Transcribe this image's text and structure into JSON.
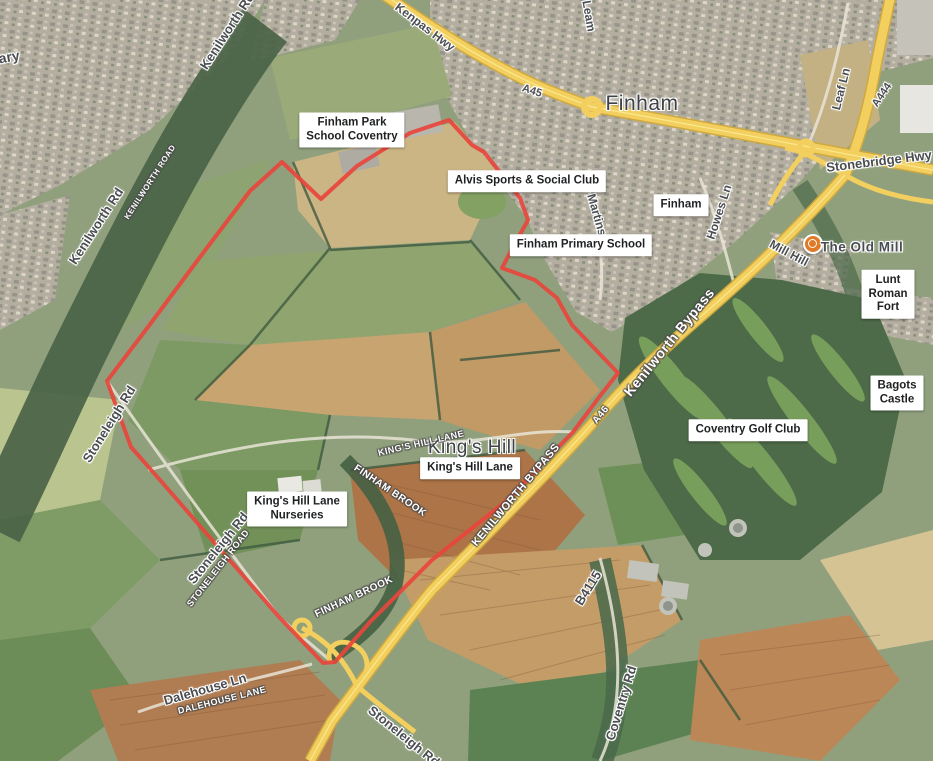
{
  "map": {
    "colors": {
      "boundary_red": "#e8453c",
      "highway_yellow": "#f4d263",
      "label_gray": "#4a4d51",
      "boxed_label_bg": "#ffffff",
      "marker_orange": "#e07a26"
    },
    "city_label": {
      "text": "Finham"
    },
    "area_label": {
      "text": "King's Hill"
    },
    "poi_marker": {
      "label": "The Old Mill"
    },
    "gray_labels": [
      {
        "text": "Library",
        "x": -4,
        "y": 59,
        "rot": -10,
        "size": 14
      },
      {
        "text": "Kenilworth Rd",
        "x": 227,
        "y": 31,
        "rot": -57,
        "size": 13
      },
      {
        "text": "Leam",
        "x": 589,
        "y": 16,
        "rot": 80,
        "size": 12
      },
      {
        "text": "Kenpas Hwy",
        "x": 425,
        "y": 27,
        "rot": 37,
        "size": 12
      },
      {
        "text": "Leaf Ln",
        "x": 841,
        "y": 89,
        "rot": -76,
        "size": 12
      },
      {
        "text": "A444",
        "x": 882,
        "y": 95,
        "rot": -56,
        "size": 11
      },
      {
        "text": "A45",
        "x": 532,
        "y": 91,
        "rot": 18,
        "size": 11
      },
      {
        "text": "Stonebridge Hwy",
        "x": 879,
        "y": 161,
        "rot": -7,
        "size": 13
      },
      {
        "text": "Mill Hill",
        "x": 789,
        "y": 253,
        "rot": 28,
        "size": 12
      },
      {
        "text": "Howes Ln",
        "x": 719,
        "y": 212,
        "rot": -72,
        "size": 12
      },
      {
        "text": "St. Martins Rd",
        "x": 597,
        "y": 215,
        "rot": 74,
        "size": 12
      },
      {
        "text": "Kenilworth Rd",
        "x": 96,
        "y": 226,
        "rot": -57,
        "size": 13
      },
      {
        "text": "Stoneleigh Rd",
        "x": 109,
        "y": 424,
        "rot": -58,
        "size": 13
      },
      {
        "text": "Stoneleigh Rd",
        "x": 218,
        "y": 548,
        "rot": -51,
        "size": 13
      },
      {
        "text": "Dalehouse Ln",
        "x": 205,
        "y": 689,
        "rot": -16,
        "size": 13
      },
      {
        "text": "B4115",
        "x": 588,
        "y": 588,
        "rot": -58,
        "size": 13
      },
      {
        "text": "Coventry Rd",
        "x": 621,
        "y": 703,
        "rot": -73,
        "size": 13
      },
      {
        "text": "Stoneleigh Rd",
        "x": 404,
        "y": 736,
        "rot": 39,
        "size": 13
      }
    ],
    "white_labels": [
      {
        "text": "KENILWORTH ROAD",
        "x": 150,
        "y": 182,
        "rot": -57,
        "size": 8
      },
      {
        "text": "KING'S HILL LANE",
        "x": 421,
        "y": 443,
        "rot": -13,
        "size": 9
      },
      {
        "text": "FINHAM BROOK",
        "x": 390,
        "y": 491,
        "rot": 34,
        "size": 10
      },
      {
        "text": "FINHAM BROOK",
        "x": 354,
        "y": 597,
        "rot": -25,
        "size": 10
      },
      {
        "text": "STONELEIGH ROAD",
        "x": 218,
        "y": 568,
        "rot": -52,
        "size": 9
      },
      {
        "text": "DALEHOUSE LANE",
        "x": 222,
        "y": 700,
        "rot": -14,
        "size": 9
      },
      {
        "text": "KENILWORTH BYPASS",
        "x": 516,
        "y": 495,
        "rot": -50,
        "size": 11
      },
      {
        "text": "Kenilworth Bypass",
        "x": 669,
        "y": 342,
        "rot": -51,
        "size": 14
      },
      {
        "text": "A46",
        "x": 601,
        "y": 415,
        "rot": -51,
        "size": 10
      }
    ],
    "boxed_labels": [
      {
        "lines": [
          "Finham Park",
          "School Coventry"
        ],
        "x": 352,
        "y": 130
      },
      {
        "lines": [
          "Alvis Sports & Social Club"
        ],
        "x": 527,
        "y": 181
      },
      {
        "lines": [
          "Finham"
        ],
        "x": 681,
        "y": 205
      },
      {
        "lines": [
          "Finham Primary School"
        ],
        "x": 581,
        "y": 245
      },
      {
        "lines": [
          "Lunt Roman Fort"
        ],
        "x": 888,
        "y": 294
      },
      {
        "lines": [
          "Bagots Castle"
        ],
        "x": 897,
        "y": 393
      },
      {
        "lines": [
          "Coventry Golf Club"
        ],
        "x": 748,
        "y": 430
      },
      {
        "lines": [
          "King's Hill Lane"
        ],
        "x": 470,
        "y": 468
      },
      {
        "lines": [
          "King's Hill Lane",
          "Nurseries"
        ],
        "x": 297,
        "y": 509
      }
    ]
  }
}
